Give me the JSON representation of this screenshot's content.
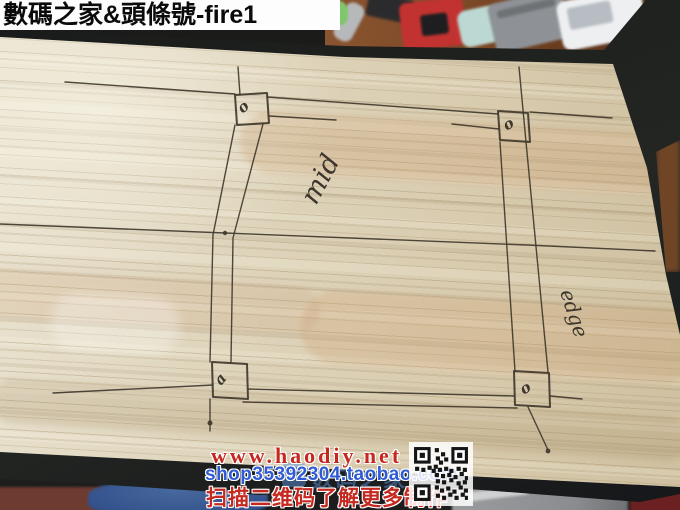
{
  "banner": {
    "text": "數碼之家&頭條號-fire1"
  },
  "drawing": {
    "mid_label": "mid",
    "edge_label": "edge",
    "corner_marks": [
      "o",
      "o",
      "a",
      "o"
    ]
  },
  "footer": {
    "site_url": "www.haodiy.net",
    "shop_url": "shop35392304.taobao.com",
    "caption": "扫描二维码了解更多制作",
    "watermark": "数码之家"
  },
  "colors": {
    "wood": "#ddd3ba",
    "pencil_line": "#40382d",
    "url_red": "#c5281f",
    "shop_blue": "#2f5bd4",
    "watermark_blue": "#5b8fd9",
    "banner_bg": "#fdfdfd",
    "banner_text": "#0b0b0b"
  }
}
